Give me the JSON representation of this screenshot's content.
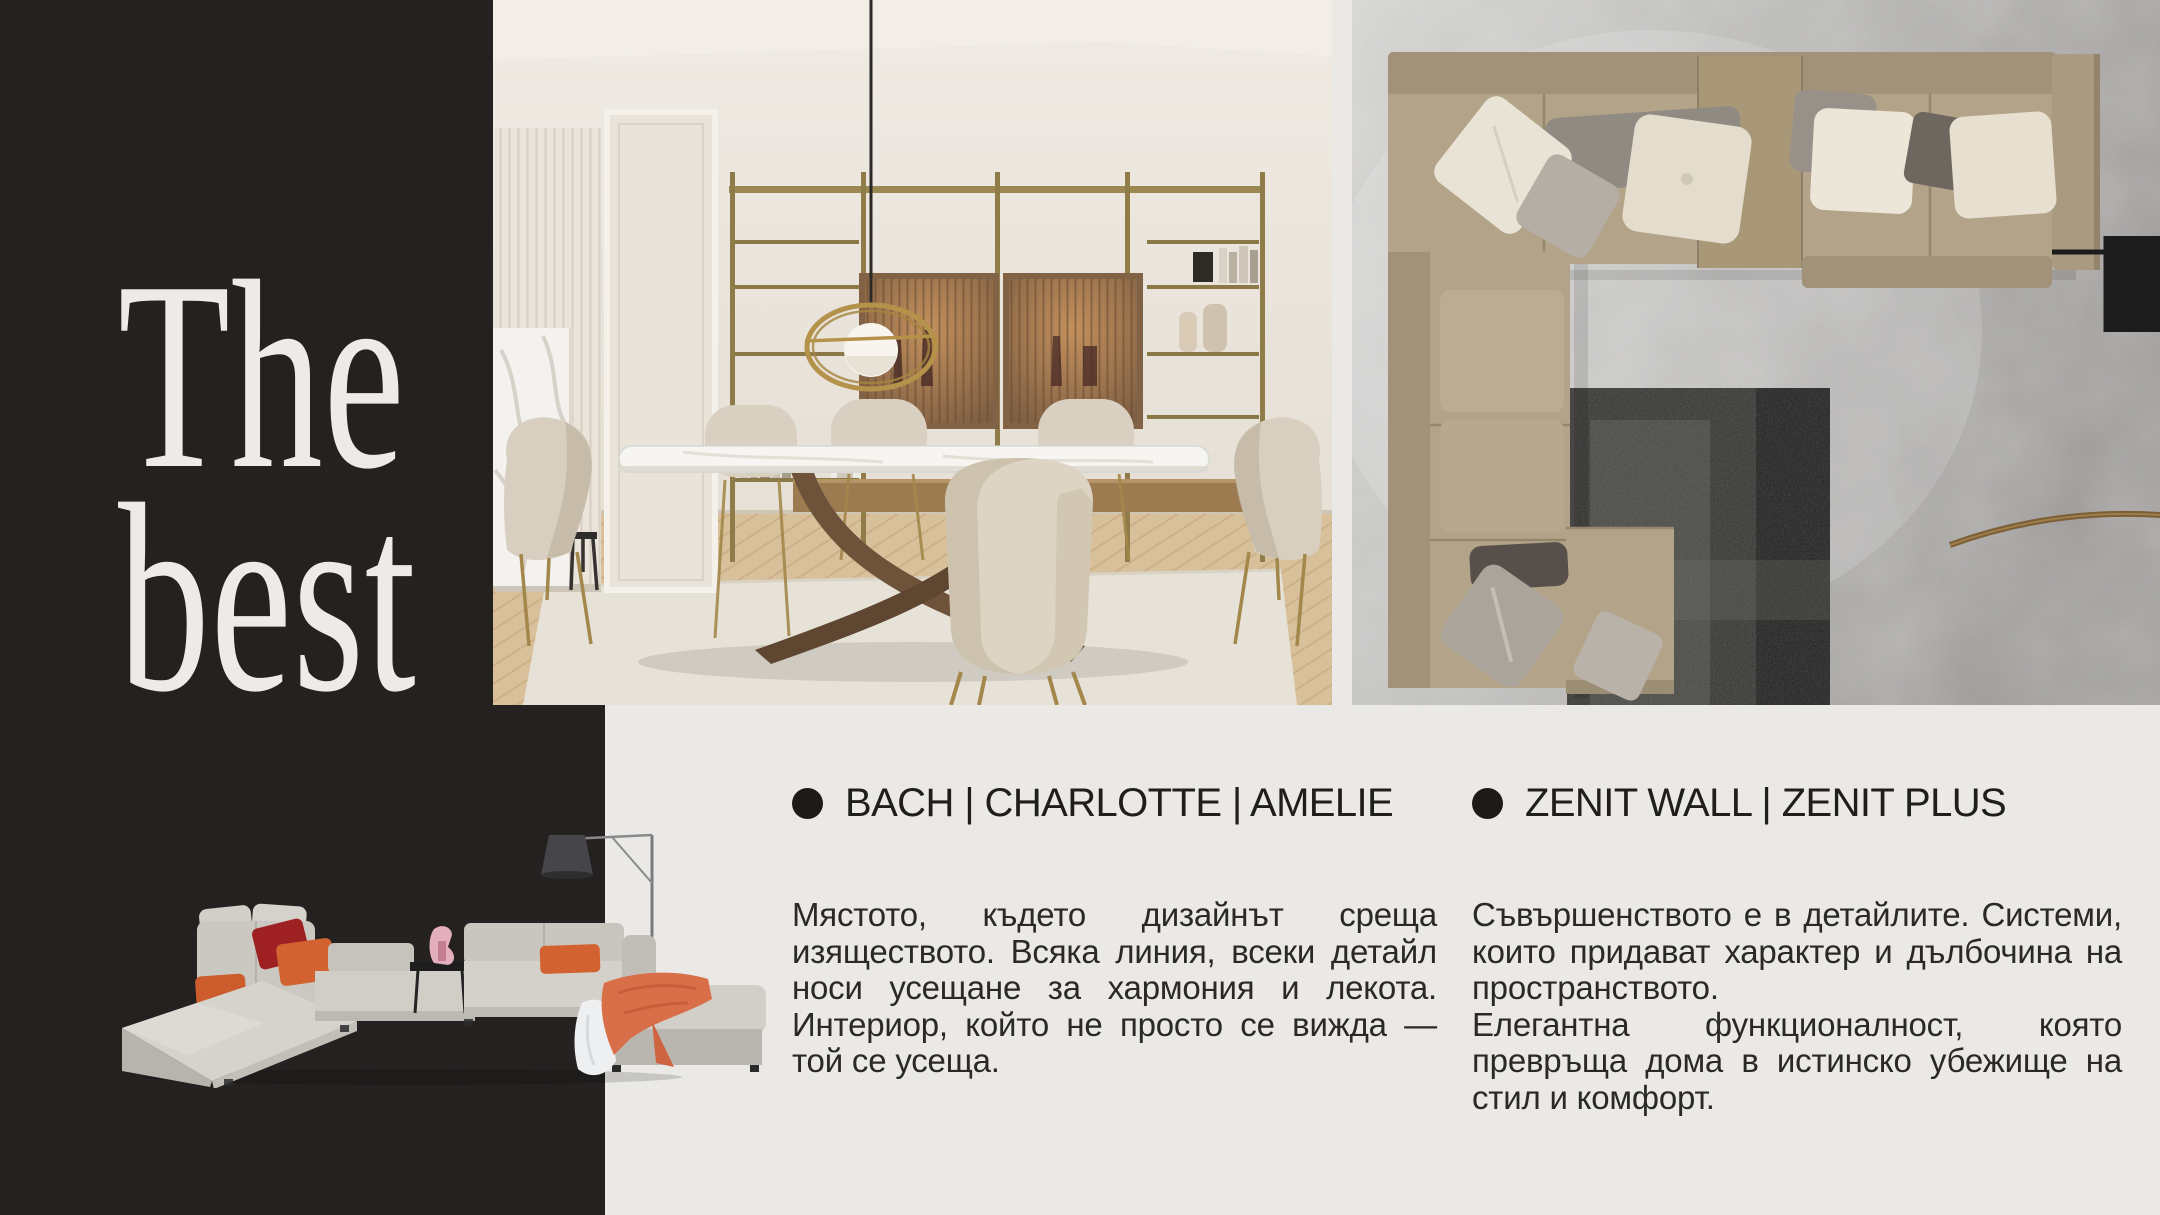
{
  "palette": {
    "dark_panel": "#242120",
    "page_background": "#eae9e6",
    "hero_text": "#edebe7",
    "heading_text": "#201e1b",
    "body_text": "#2b2927",
    "accent_orange": "#d2622f",
    "accent_red": "#9e2023",
    "brass": "#a58a4e"
  },
  "hero": {
    "line1": "The",
    "line2": "best"
  },
  "sections": [
    {
      "heading": "BACH | CHARLOTTE | AMELIE",
      "paragraphs": [
        [
          "Мястото, където дизайнът среща",
          "изяществото. Всяка линия, всеки детайл",
          "носи усещане за хармония и лекота.",
          "Интериор, който не просто се вижда —",
          "той се усеща."
        ]
      ]
    },
    {
      "heading": "ZENIT WALL | ZENIT PLUS",
      "paragraphs": [
        [
          "Съвършенството е в детайлите. Системи,",
          "които придават характер и дълбочина на",
          "пространството."
        ],
        [
          "Елегантна функционалност, която",
          "превръща дома в истинско убежище на",
          "стил и комфорт."
        ]
      ]
    }
  ]
}
